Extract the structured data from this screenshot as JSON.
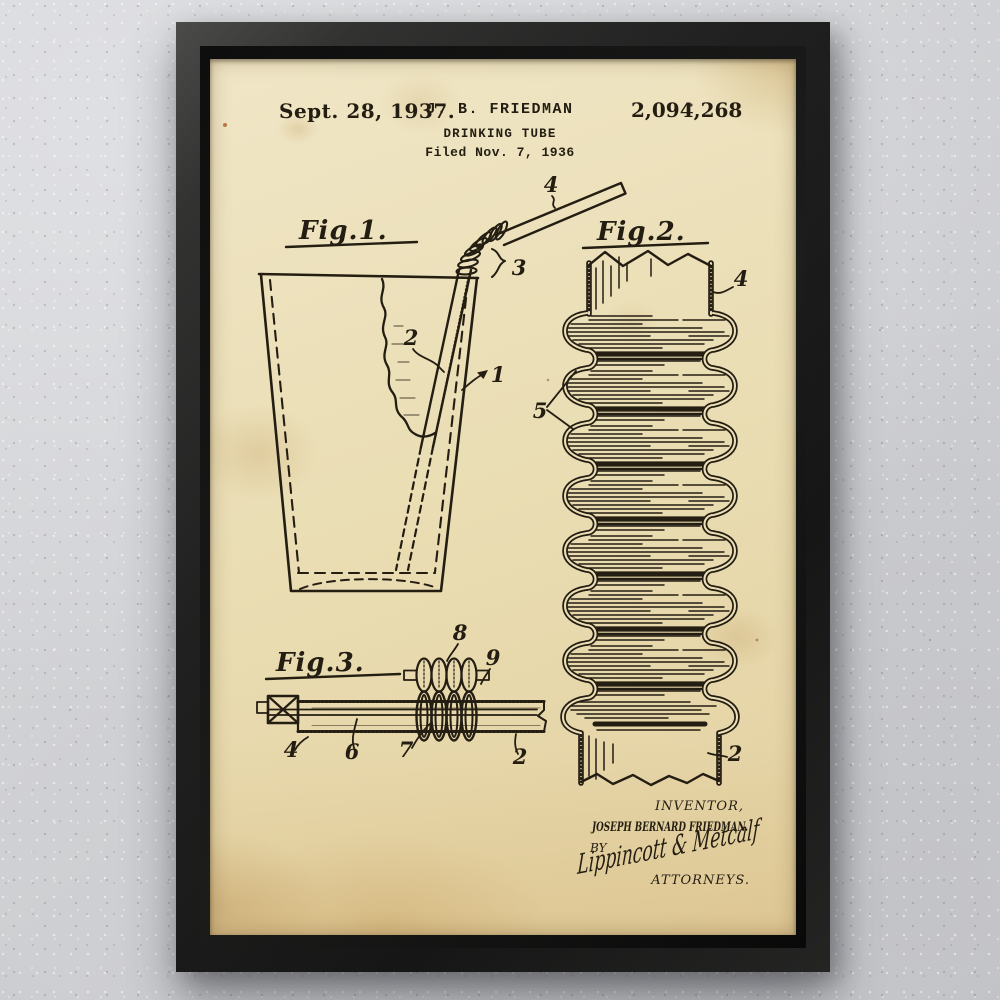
{
  "artwork": {
    "header": {
      "date": "Sept. 28, 1937.",
      "inventor": "J. B. FRIEDMAN",
      "title": "DRINKING TUBE",
      "filed": "Filed Nov. 7, 1936",
      "patent_number": "2,094,268"
    },
    "figures": {
      "fig1": {
        "label": "Fig.1.",
        "ref_4": "4",
        "ref_3": "3",
        "ref_2": "2",
        "ref_1": "1"
      },
      "fig2": {
        "label": "Fig.2.",
        "ref_4": "4",
        "ref_5": "5",
        "ref_2": "2"
      },
      "fig3": {
        "label": "Fig.3.",
        "ref_8": "8",
        "ref_9": "9",
        "ref_4": "4",
        "ref_6": "6",
        "ref_7": "7",
        "ref_2": "2"
      }
    },
    "signature_block": {
      "inventor_caption": "INVENTOR,",
      "inventor_name": "JOSEPH BERNARD FRIEDMAN.",
      "by_label": "BY",
      "signature": "Lippincott & Metcalf",
      "attorneys_caption": "ATTORNEYS."
    },
    "colors": {
      "paper": "#e9dcb1",
      "ink": "#241d12",
      "frame": "#1a1a1a",
      "wall": "#cfd0d3"
    }
  }
}
